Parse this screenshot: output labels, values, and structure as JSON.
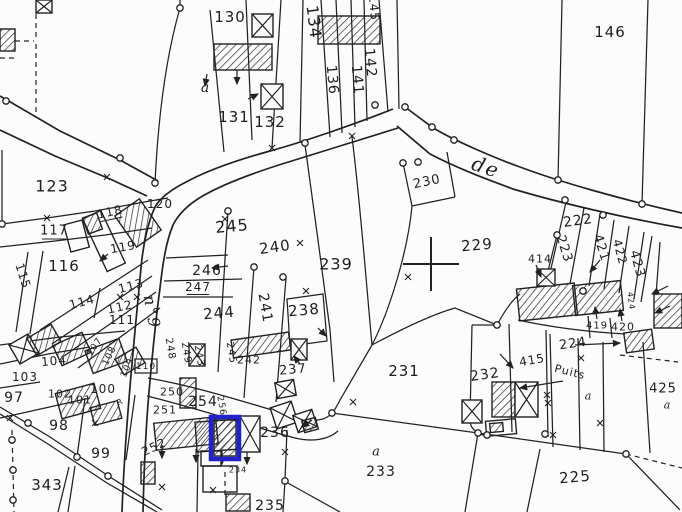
{
  "map": {
    "type": "cadastral-parcel-map",
    "paper_color": "#fcfcfc",
    "line_color": "#222222",
    "highlight_color": "#2222cc",
    "street_names": [
      "de",
      "n°9"
    ],
    "well_label": "Puits",
    "highlight": {
      "x": 211,
      "y": 417,
      "w": 28,
      "h": 42
    },
    "survey_cross": {
      "x": 431,
      "y": 264,
      "hw": 28,
      "hh": 27
    },
    "labels": [
      {
        "t": "130",
        "x": 230,
        "y": 17,
        "s": 15
      },
      {
        "t": "a",
        "x": 206,
        "y": 88,
        "s": 14,
        "f": "i"
      },
      {
        "t": "131",
        "x": 234,
        "y": 117,
        "s": 15
      },
      {
        "t": "132",
        "x": 270,
        "y": 122,
        "s": 15
      },
      {
        "t": "134",
        "x": 314,
        "y": 22,
        "r": 83,
        "s": 16
      },
      {
        "t": "136",
        "x": 332,
        "y": 80,
        "r": 85,
        "s": 14
      },
      {
        "t": "141",
        "x": 357,
        "y": 80,
        "r": 85,
        "s": 14
      },
      {
        "t": "142",
        "x": 370,
        "y": 63,
        "r": 85,
        "s": 14
      },
      {
        "t": "145",
        "x": 374,
        "y": 8,
        "r": 85,
        "s": 12
      },
      {
        "t": "146",
        "x": 610,
        "y": 32,
        "s": 15
      },
      {
        "t": "de",
        "x": 486,
        "y": 167,
        "r": 19,
        "s": 20,
        "f": "i"
      },
      {
        "t": "230",
        "x": 427,
        "y": 182,
        "r": -12,
        "s": 13
      },
      {
        "t": "229",
        "x": 477,
        "y": 245,
        "r": -5,
        "s": 15
      },
      {
        "t": "222",
        "x": 578,
        "y": 221,
        "r": -8,
        "s": 14
      },
      {
        "t": "223",
        "x": 564,
        "y": 249,
        "r": 72,
        "s": 13
      },
      {
        "t": "421",
        "x": 601,
        "y": 248,
        "r": 72,
        "s": 13
      },
      {
        "t": "422",
        "x": 620,
        "y": 252,
        "r": 75,
        "s": 12
      },
      {
        "t": "423",
        "x": 637,
        "y": 264,
        "r": 75,
        "s": 13
      },
      {
        "t": "424",
        "x": 631,
        "y": 301,
        "r": 83,
        "s": 8
      },
      {
        "t": "419",
        "x": 597,
        "y": 326,
        "s": 10
      },
      {
        "t": "420",
        "x": 623,
        "y": 327,
        "s": 11
      },
      {
        "t": "414",
        "x": 540,
        "y": 259,
        "s": 11
      },
      {
        "t": "224",
        "x": 573,
        "y": 344,
        "r": -8,
        "s": 13
      },
      {
        "t": "Puits",
        "x": 570,
        "y": 372,
        "r": 14,
        "s": 11
      },
      {
        "t": "a",
        "x": 589,
        "y": 396,
        "s": 11,
        "f": "i"
      },
      {
        "t": "425",
        "x": 663,
        "y": 389,
        "s": 13
      },
      {
        "t": "a",
        "x": 668,
        "y": 405,
        "s": 11,
        "f": "i"
      },
      {
        "t": "232",
        "x": 485,
        "y": 375,
        "r": -8,
        "s": 14
      },
      {
        "t": "415",
        "x": 532,
        "y": 360,
        "r": -10,
        "s": 12
      },
      {
        "t": "231",
        "x": 404,
        "y": 371,
        "s": 15
      },
      {
        "t": "237",
        "x": 293,
        "y": 370,
        "r": -5,
        "s": 13
      },
      {
        "t": "239",
        "x": 336,
        "y": 264,
        "s": 16
      },
      {
        "t": "238",
        "x": 304,
        "y": 310,
        "r": -5,
        "s": 15
      },
      {
        "t": "240",
        "x": 275,
        "y": 247,
        "r": -8,
        "s": 15
      },
      {
        "t": "241",
        "x": 265,
        "y": 308,
        "r": 80,
        "s": 14
      },
      {
        "t": "244",
        "x": 219,
        "y": 313,
        "r": -5,
        "s": 15
      },
      {
        "t": "245",
        "x": 232,
        "y": 226,
        "r": -5,
        "s": 16
      },
      {
        "t": "246",
        "x": 207,
        "y": 271,
        "s": 14
      },
      {
        "t": "247",
        "x": 198,
        "y": 287,
        "s": 12,
        "f": "u"
      },
      {
        "t": "242",
        "x": 249,
        "y": 360,
        "s": 11
      },
      {
        "t": "248",
        "x": 170,
        "y": 349,
        "r": 80,
        "s": 10
      },
      {
        "t": "249",
        "x": 186,
        "y": 353,
        "r": 80,
        "s": 10
      },
      {
        "t": "243",
        "x": 199,
        "y": 356,
        "r": 80,
        "s": 10
      },
      {
        "t": "245",
        "x": 231,
        "y": 353,
        "r": 80,
        "s": 10
      },
      {
        "t": "110",
        "x": 146,
        "y": 367,
        "s": 9,
        "f": "b"
      },
      {
        "t": "250",
        "x": 172,
        "y": 392,
        "s": 11
      },
      {
        "t": "251",
        "x": 165,
        "y": 410,
        "s": 11
      },
      {
        "t": "254",
        "x": 203,
        "y": 402,
        "s": 14
      },
      {
        "t": "256",
        "x": 221,
        "y": 406,
        "r": 80,
        "s": 9
      },
      {
        "t": "252",
        "x": 154,
        "y": 447,
        "r": -25,
        "s": 12
      },
      {
        "t": "236",
        "x": 275,
        "y": 433,
        "s": 14
      },
      {
        "t": "235",
        "x": 270,
        "y": 506,
        "s": 14
      },
      {
        "t": "234",
        "x": 238,
        "y": 470,
        "s": 8
      },
      {
        "t": "a",
        "x": 377,
        "y": 452,
        "s": 13,
        "f": "i"
      },
      {
        "t": "233",
        "x": 381,
        "y": 472,
        "s": 14
      },
      {
        "t": "225",
        "x": 575,
        "y": 477,
        "r": -5,
        "s": 15
      },
      {
        "t": "123",
        "x": 52,
        "y": 186,
        "s": 16
      },
      {
        "t": "117",
        "x": 54,
        "y": 231,
        "s": 13,
        "f": "u"
      },
      {
        "t": "118",
        "x": 110,
        "y": 212,
        "r": -12,
        "s": 12,
        "f": "u"
      },
      {
        "t": "119",
        "x": 123,
        "y": 247,
        "r": -10,
        "s": 12
      },
      {
        "t": "120",
        "x": 160,
        "y": 204,
        "s": 12
      },
      {
        "t": "116",
        "x": 64,
        "y": 266,
        "s": 15
      },
      {
        "t": "115",
        "x": 23,
        "y": 276,
        "r": 72,
        "s": 12
      },
      {
        "t": "113",
        "x": 131,
        "y": 286,
        "r": -15,
        "s": 12
      },
      {
        "t": "114",
        "x": 82,
        "y": 302,
        "r": -15,
        "s": 12
      },
      {
        "t": "112",
        "x": 120,
        "y": 307,
        "r": -12,
        "s": 12
      },
      {
        "t": "111",
        "x": 122,
        "y": 320,
        "s": 12
      },
      {
        "t": "n°9",
        "x": 152,
        "y": 312,
        "r": 80,
        "s": 16,
        "f": "i"
      },
      {
        "t": "104",
        "x": 54,
        "y": 361,
        "r": -5,
        "s": 12
      },
      {
        "t": "103",
        "x": 25,
        "y": 377,
        "s": 12
      },
      {
        "t": "102",
        "x": 60,
        "y": 394,
        "s": 11
      },
      {
        "t": "101",
        "x": 80,
        "y": 400,
        "s": 11
      },
      {
        "t": "100",
        "x": 103,
        "y": 389,
        "s": 12
      },
      {
        "t": "107",
        "x": 95,
        "y": 347,
        "r": -55,
        "s": 9
      },
      {
        "t": "108",
        "x": 110,
        "y": 356,
        "r": -65,
        "s": 9
      },
      {
        "t": "109",
        "x": 128,
        "y": 368,
        "r": -65,
        "s": 9
      },
      {
        "t": "R",
        "x": 120,
        "y": 402,
        "r": -25,
        "s": 8
      },
      {
        "t": "97",
        "x": 14,
        "y": 398,
        "s": 14
      },
      {
        "t": "98",
        "x": 59,
        "y": 426,
        "s": 14
      },
      {
        "t": "99",
        "x": 101,
        "y": 454,
        "s": 14
      },
      {
        "t": "343",
        "x": 47,
        "y": 485,
        "s": 15
      }
    ],
    "buildings": [
      {
        "k": "h",
        "x": 214,
        "y": 44,
        "w": 58,
        "h": 26,
        "r": 0
      },
      {
        "k": "h",
        "x": 318,
        "y": 16,
        "w": 62,
        "h": 28,
        "r": 0
      },
      {
        "k": "x",
        "x": 252,
        "y": 14,
        "w": 21,
        "h": 23,
        "r": 0
      },
      {
        "k": "x",
        "x": 261,
        "y": 84,
        "w": 22,
        "h": 25,
        "r": 0
      },
      {
        "k": "x",
        "x": 36,
        "y": 0,
        "w": 16,
        "h": 13,
        "r": 0
      },
      {
        "k": "h",
        "x": 0,
        "y": 29,
        "w": 15,
        "h": 22,
        "r": 0
      },
      {
        "k": "h",
        "x": 123,
        "y": 204,
        "w": 30,
        "h": 38,
        "r": -35
      },
      {
        "k": "o",
        "x": 67,
        "y": 222,
        "w": 19,
        "h": 28,
        "r": -15
      },
      {
        "k": "o",
        "x": 94,
        "y": 212,
        "w": 20,
        "h": 58,
        "r": -25
      },
      {
        "k": "h",
        "x": 85,
        "y": 215,
        "w": 15,
        "h": 17,
        "r": -20
      },
      {
        "k": "x",
        "x": 13,
        "y": 338,
        "w": 22,
        "h": 22,
        "r": -30
      },
      {
        "k": "h",
        "x": 30,
        "y": 330,
        "w": 28,
        "h": 20,
        "r": -30
      },
      {
        "k": "h",
        "x": 56,
        "y": 338,
        "w": 32,
        "h": 22,
        "r": -25
      },
      {
        "k": "h",
        "x": 88,
        "y": 344,
        "w": 36,
        "h": 24,
        "r": -20
      },
      {
        "k": "h",
        "x": 118,
        "y": 352,
        "w": 24,
        "h": 18,
        "r": -30
      },
      {
        "k": "h",
        "x": 58,
        "y": 388,
        "w": 40,
        "h": 26,
        "r": -15
      },
      {
        "k": "h",
        "x": 92,
        "y": 404,
        "w": 28,
        "h": 18,
        "r": -15
      },
      {
        "k": "h",
        "x": 141,
        "y": 462,
        "w": 14,
        "h": 22,
        "r": 0
      },
      {
        "k": "h",
        "x": 155,
        "y": 420,
        "w": 62,
        "h": 27,
        "r": -6
      },
      {
        "k": "h",
        "x": 180,
        "y": 378,
        "w": 16,
        "h": 30,
        "r": 0
      },
      {
        "k": "h",
        "x": 196,
        "y": 420,
        "w": 60,
        "h": 30,
        "r": -4
      },
      {
        "k": "x",
        "x": 240,
        "y": 416,
        "w": 20,
        "h": 36,
        "r": 0
      },
      {
        "k": "h",
        "x": 214,
        "y": 420,
        "w": 22,
        "h": 36,
        "r": 0
      },
      {
        "k": "x",
        "x": 189,
        "y": 344,
        "w": 16,
        "h": 22,
        "r": 0
      },
      {
        "k": "h",
        "x": 232,
        "y": 336,
        "w": 58,
        "h": 18,
        "r": -8
      },
      {
        "k": "x",
        "x": 291,
        "y": 339,
        "w": 16,
        "h": 21,
        "r": 0
      },
      {
        "k": "x",
        "x": 276,
        "y": 381,
        "w": 19,
        "h": 16,
        "r": -10
      },
      {
        "k": "x",
        "x": 273,
        "y": 404,
        "w": 22,
        "h": 22,
        "r": -18
      },
      {
        "k": "x",
        "x": 295,
        "y": 412,
        "w": 20,
        "h": 18,
        "r": -18
      },
      {
        "k": "h",
        "x": 303,
        "y": 419,
        "w": 14,
        "h": 12,
        "r": -15
      },
      {
        "k": "h",
        "x": 226,
        "y": 494,
        "w": 24,
        "h": 17,
        "r": 0
      },
      {
        "k": "o",
        "x": 203,
        "y": 466,
        "w": 34,
        "h": 26,
        "r": 0
      },
      {
        "k": "o",
        "x": 201,
        "y": 451,
        "w": 20,
        "h": 15,
        "r": 0
      },
      {
        "k": "h",
        "x": 518,
        "y": 286,
        "w": 58,
        "h": 32,
        "r": -6
      },
      {
        "k": "h",
        "x": 574,
        "y": 283,
        "w": 48,
        "h": 30,
        "r": -6
      },
      {
        "k": "x",
        "x": 537,
        "y": 269,
        "w": 18,
        "h": 17,
        "r": 0
      },
      {
        "k": "h",
        "x": 625,
        "y": 331,
        "w": 28,
        "h": 20,
        "r": -8
      },
      {
        "k": "h",
        "x": 654,
        "y": 294,
        "w": 28,
        "h": 34,
        "r": 0
      },
      {
        "k": "h",
        "x": 492,
        "y": 382,
        "w": 23,
        "h": 35,
        "r": 0
      },
      {
        "k": "x",
        "x": 515,
        "y": 382,
        "w": 23,
        "h": 35,
        "r": 0
      },
      {
        "k": "x",
        "x": 462,
        "y": 400,
        "w": 20,
        "h": 23,
        "r": 0
      },
      {
        "k": "o",
        "x": 486,
        "y": 420,
        "w": 30,
        "h": 15,
        "r": -5
      },
      {
        "k": "h",
        "x": 490,
        "y": 423,
        "w": 13,
        "h": 9,
        "r": -5
      }
    ],
    "nodes": [
      [
        180,
        8
      ],
      [
        6,
        101
      ],
      [
        120,
        158
      ],
      [
        155,
        183
      ],
      [
        2,
        224
      ],
      [
        228,
        211
      ],
      [
        254,
        267
      ],
      [
        283,
        277
      ],
      [
        305,
        143
      ],
      [
        375,
        105
      ],
      [
        405,
        107
      ],
      [
        432,
        127
      ],
      [
        454,
        140
      ],
      [
        558,
        180
      ],
      [
        642,
        204
      ],
      [
        403,
        163
      ],
      [
        418,
        162
      ],
      [
        565,
        200
      ],
      [
        603,
        215
      ],
      [
        557,
        235
      ],
      [
        583,
        291
      ],
      [
        497,
        325
      ],
      [
        487,
        435
      ],
      [
        545,
        434
      ],
      [
        332,
        413
      ],
      [
        478,
        433
      ],
      [
        626,
        454
      ],
      [
        285,
        481
      ],
      [
        28,
        423
      ],
      [
        77,
        457
      ],
      [
        108,
        476
      ],
      [
        12,
        440
      ],
      [
        13,
        470
      ],
      [
        13,
        500
      ]
    ],
    "xmarks": [
      [
        47,
        218
      ],
      [
        107,
        177
      ],
      [
        225,
        219
      ],
      [
        272,
        148
      ],
      [
        352,
        136
      ],
      [
        300,
        243
      ],
      [
        306,
        291
      ],
      [
        408,
        277
      ],
      [
        120,
        297
      ],
      [
        137,
        297
      ],
      [
        353,
        402
      ],
      [
        547,
        395
      ],
      [
        600,
        423
      ],
      [
        548,
        403
      ],
      [
        553,
        435
      ],
      [
        581,
        358
      ],
      [
        213,
        490
      ],
      [
        285,
        452
      ],
      [
        10,
        418
      ],
      [
        95,
        423
      ],
      [
        162,
        487
      ]
    ],
    "arrows": [
      [
        237,
        70,
        237,
        84
      ],
      [
        207,
        74,
        205,
        86
      ],
      [
        248,
        99,
        258,
        94
      ],
      [
        228,
        266,
        212,
        268
      ],
      [
        318,
        328,
        326,
        336
      ],
      [
        300,
        364,
        294,
        356
      ],
      [
        536,
        265,
        541,
        277
      ],
      [
        597,
        319,
        595,
        307
      ],
      [
        622,
        321,
        620,
        309
      ],
      [
        563,
        381,
        520,
        388
      ],
      [
        500,
        354,
        513,
        368
      ],
      [
        575,
        345,
        620,
        343
      ],
      [
        668,
        286,
        652,
        294
      ],
      [
        670,
        306,
        655,
        313
      ],
      [
        162,
        445,
        162,
        458
      ],
      [
        196,
        449,
        196,
        462
      ],
      [
        222,
        451,
        222,
        464
      ],
      [
        247,
        452,
        247,
        464
      ],
      [
        312,
        420,
        302,
        427
      ],
      [
        600,
        260,
        590,
        272
      ],
      [
        108,
        254,
        100,
        261
      ]
    ]
  }
}
